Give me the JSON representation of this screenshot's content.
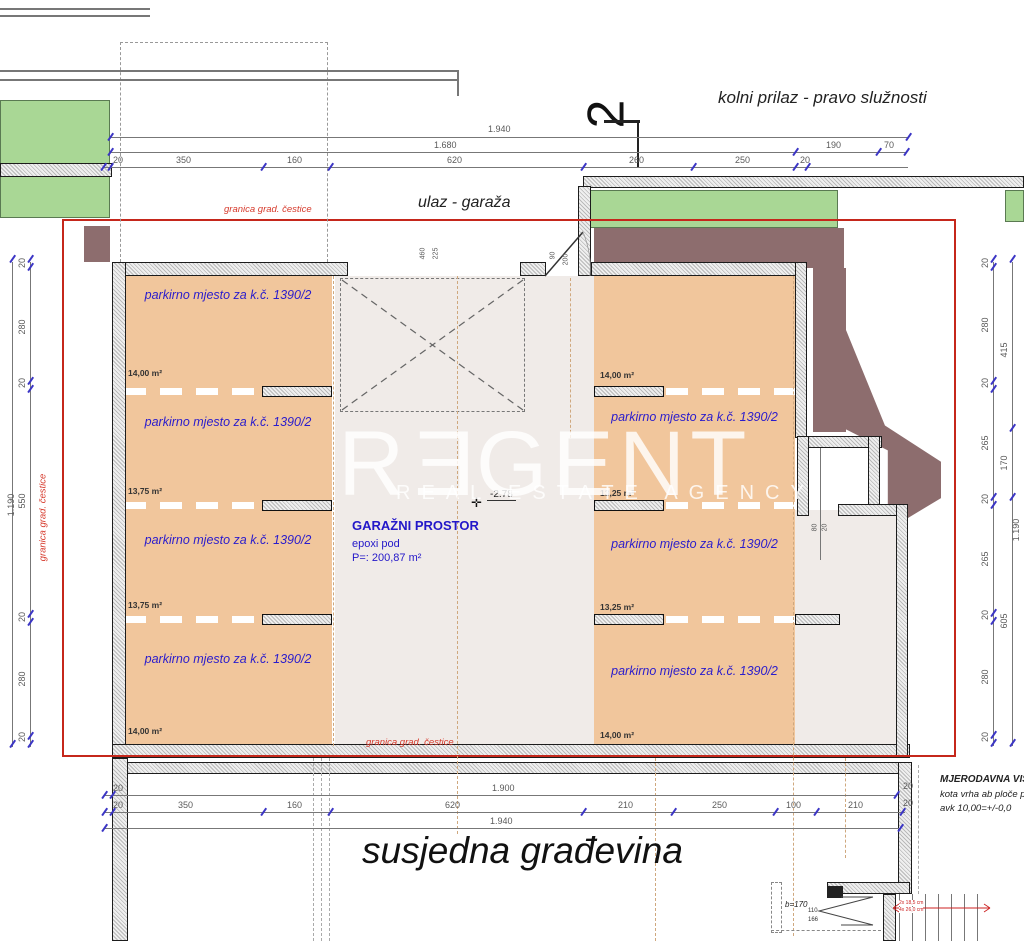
{
  "labels": {
    "kolni_prilaz": "kolni prilaz - pravo služnosti",
    "ulaz_garaza": "ulaz - garaža",
    "susjedna": "susjedna građevina",
    "section_no": "2",
    "granica": "granica grad. čestice"
  },
  "garage": {
    "title": "GARAŽNI PROSTOR",
    "sub": "epoxi pod",
    "area": "P=: 200,87 m²",
    "level": "-2.78"
  },
  "parking": {
    "label": "parkirno mjesto za k.č. 1390/2",
    "left_areas": [
      "14,00 m²",
      "13,75 m²",
      "13,75 m²",
      "14,00 m²"
    ],
    "right_areas": [
      "14,00 m²",
      "13,25 m²",
      "13,25 m²",
      "14,00 m²"
    ]
  },
  "watermark": {
    "p1": "R",
    "p2": "E",
    "p3": "GENT",
    "tagline": "REAL ESTATE AGENCY"
  },
  "note": {
    "l1": "MJERODAVNA VIS",
    "l2": "kota vrha ab ploče pr",
    "l3": "avk 10,00=+/-0,0"
  },
  "stair": {
    "b": "b=170",
    "n1": "110",
    "n2": "166",
    "r1": "2x 18,5 cm",
    "r2": "4x 26,0 cm"
  },
  "dims": {
    "t1": [
      "1.940"
    ],
    "t2": [
      "1.680",
      "190",
      "70"
    ],
    "t3": [
      "20",
      "350",
      "160",
      "620",
      "260",
      "250",
      "20"
    ],
    "b1": [
      "20",
      "1.900"
    ],
    "b2": [
      "20",
      "350",
      "160",
      "620",
      "210",
      "250",
      "100",
      "210"
    ],
    "b2r": [
      "20",
      "20"
    ],
    "b3": [
      "1.940"
    ],
    "li": [
      "20",
      "280",
      "20",
      "550",
      "20",
      "280",
      "20"
    ],
    "lo": "1.190",
    "ri": [
      "20",
      "280",
      "20",
      "265",
      "20",
      "265",
      "20",
      "280",
      "20"
    ],
    "ro": [
      "415",
      "170",
      "605"
    ],
    "ro_total": "1.190",
    "door": [
      "90",
      "200"
    ],
    "opening": [
      "460",
      "225"
    ],
    "niche": [
      "80",
      "20"
    ]
  },
  "colors": {
    "boundary": "#c5271b",
    "parking": "#f1c69c",
    "lawn": "#a9d795",
    "mass": "#8d6d6e",
    "label_blue": "#2a1ccc"
  }
}
